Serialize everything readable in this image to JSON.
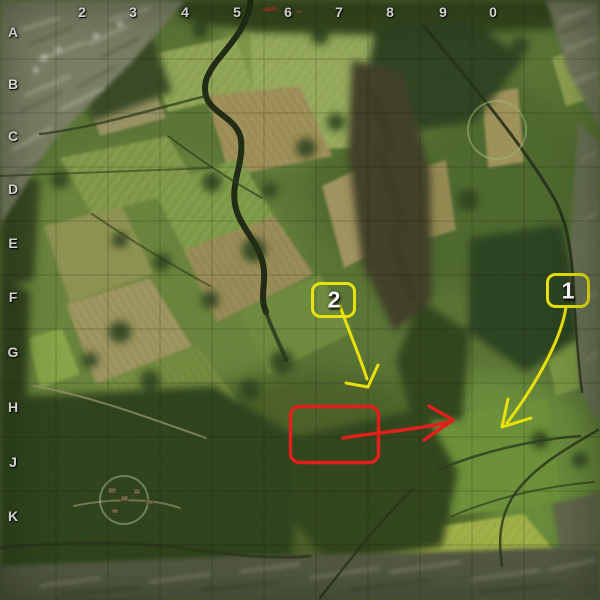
{
  "grid": {
    "column_labels": [
      "2",
      "3",
      "4",
      "5",
      "6",
      "7",
      "8",
      "9",
      "0"
    ],
    "row_labels": [
      "A",
      "B",
      "C",
      "D",
      "E",
      "F",
      "G",
      "H",
      "J",
      "K"
    ]
  },
  "annotations": {
    "marker_1_label": "1",
    "marker_2_label": "2",
    "marker_color": "#e8e10c",
    "target_color": "#e0201a"
  }
}
